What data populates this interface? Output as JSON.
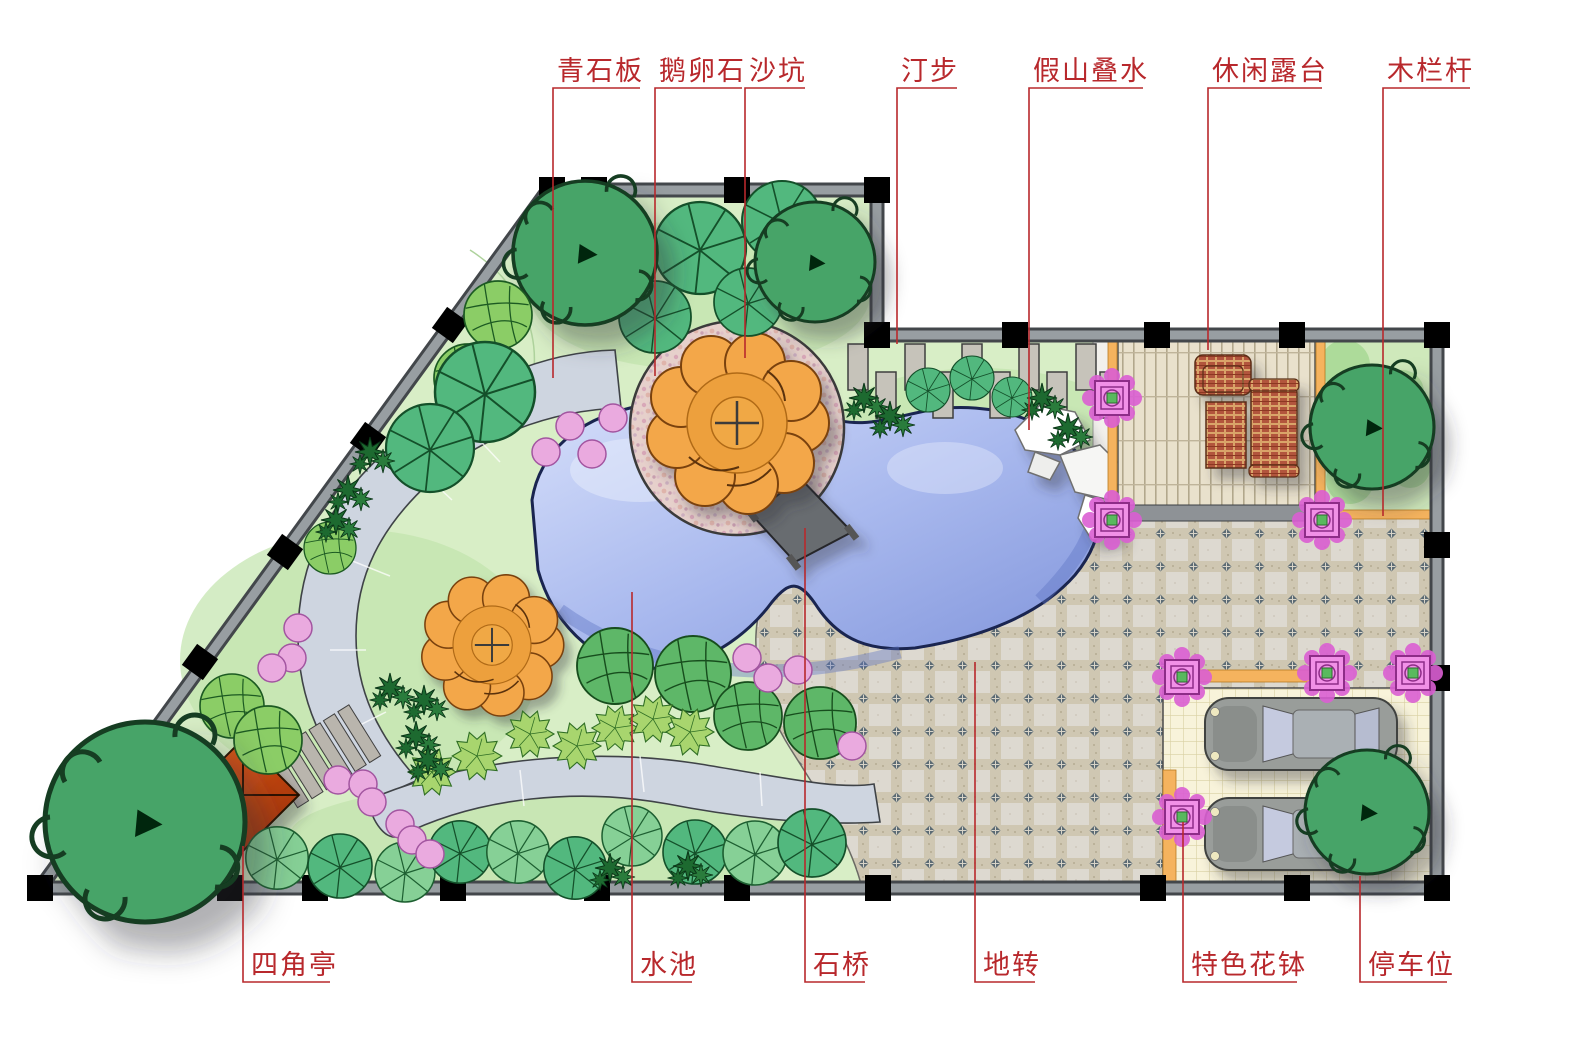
{
  "diagram": {
    "title": "garden-landscape-plan",
    "annotation_color": "#b8282c",
    "annotations_top": [
      {
        "label": "青石板",
        "target": "bluestone-slab-path"
      },
      {
        "label": "鹅卵石",
        "target": "pebble-ring"
      },
      {
        "label": "沙坑",
        "target": "sand-pit"
      },
      {
        "label": "汀步",
        "target": "stepping-stones"
      },
      {
        "label": "假山叠水",
        "target": "rockery-waterfall"
      },
      {
        "label": "休闲露台",
        "target": "leisure-terrace"
      },
      {
        "label": "木栏杆",
        "target": "wood-railing"
      }
    ],
    "annotations_bottom": [
      {
        "label": "四角亭",
        "target": "four-corner-pavilion"
      },
      {
        "label": "水池",
        "target": "pond"
      },
      {
        "label": "石桥",
        "target": "stone-bridge"
      },
      {
        "label": "地转",
        "target": "paving-tiles"
      },
      {
        "label": "特色花钵",
        "target": "feature-flower-pots"
      },
      {
        "label": "停车位",
        "target": "parking-space"
      }
    ],
    "colors": {
      "annotation": "#b8282c",
      "lawn": "#d8eec6",
      "pond": "#a9b9ee",
      "stone_path": "#ced5e0",
      "pebble_ring": "#e6d0cb",
      "pavilion": "#d1491c",
      "orange_tree": "#f3a74a",
      "plaza_tile": "#ddd9d0",
      "parking": "#f7f2d6",
      "deck": "#e9e1cc",
      "wall": "#989ea2",
      "flower_pot": "#e879dd",
      "railing": "#f5b35e"
    }
  }
}
